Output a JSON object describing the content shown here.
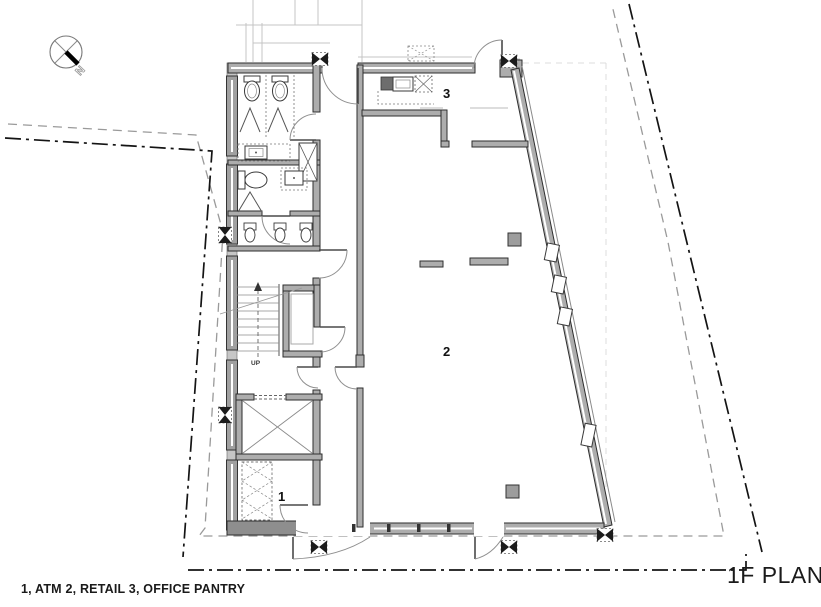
{
  "title_block": {
    "plan_title": "1F PLAN"
  },
  "legend": {
    "text": "1, ATM 2, RETAIL 3, OFFICE PANTRY",
    "rooms": [
      {
        "number": "1",
        "name": "ATM"
      },
      {
        "number": "2",
        "name": "RETAIL"
      },
      {
        "number": "3",
        "name": "OFFICE PANTRY"
      }
    ]
  },
  "compass": {
    "label": "N"
  },
  "plan_labels": {
    "room_1": "1",
    "room_2": "2",
    "room_3": "3",
    "stair_direction": "UP"
  },
  "colors": {
    "wall_fill": "#adadad",
    "wall_line": "#2e2e2e",
    "property_line": "#141414",
    "setback_line": "#9a9a9a",
    "column_fill": "#9d9d9d",
    "guide_line": "#c4c4c4"
  }
}
